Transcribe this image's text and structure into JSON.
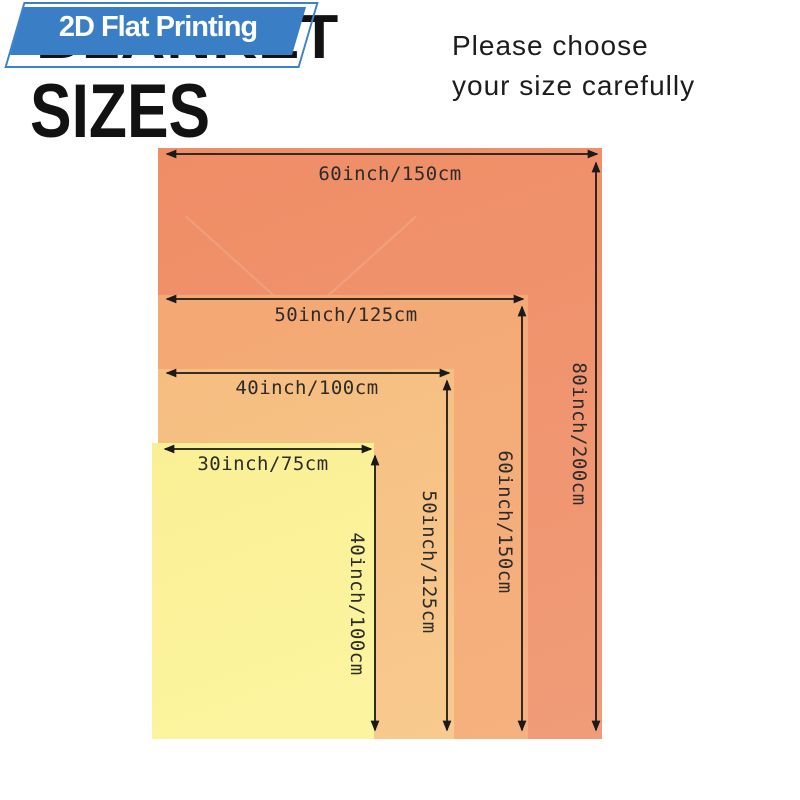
{
  "badge": {
    "label": "2D Flat Printing",
    "fill_color": "#3a7ec5",
    "outline_color": "#3d82c9",
    "text_color": "#ffffff"
  },
  "title": {
    "background_word": "BLANKET",
    "main_word": "SIZES",
    "color": "#121212"
  },
  "note": {
    "line1": "Please choose",
    "line2": "your size carefully"
  },
  "diagram": {
    "description": "Nested blanket size comparison rectangles, left- and bottom-aligned",
    "arrow_color": "#1a1a1a",
    "sizes": [
      {
        "name": "blanket-60x80",
        "width_label": "60inch/150cm",
        "height_label": "80inch/200cm",
        "color_top": "#ef8d66",
        "color_bottom": "#f09c78"
      },
      {
        "name": "blanket-50x60",
        "width_label": "50inch/125cm",
        "height_label": "60inch/150cm",
        "color_top": "#f4a873",
        "color_bottom": "#f5b17f"
      },
      {
        "name": "blanket-40x50",
        "width_label": "40inch/100cm",
        "height_label": "50inch/125cm",
        "color_top": "#f6bd80",
        "color_bottom": "#f8ca8e"
      },
      {
        "name": "blanket-30x40",
        "width_label": "30inch/75cm",
        "height_label": "40inch/100cm",
        "color_top": "#faef95",
        "color_bottom": "#fcf5a0"
      }
    ]
  }
}
